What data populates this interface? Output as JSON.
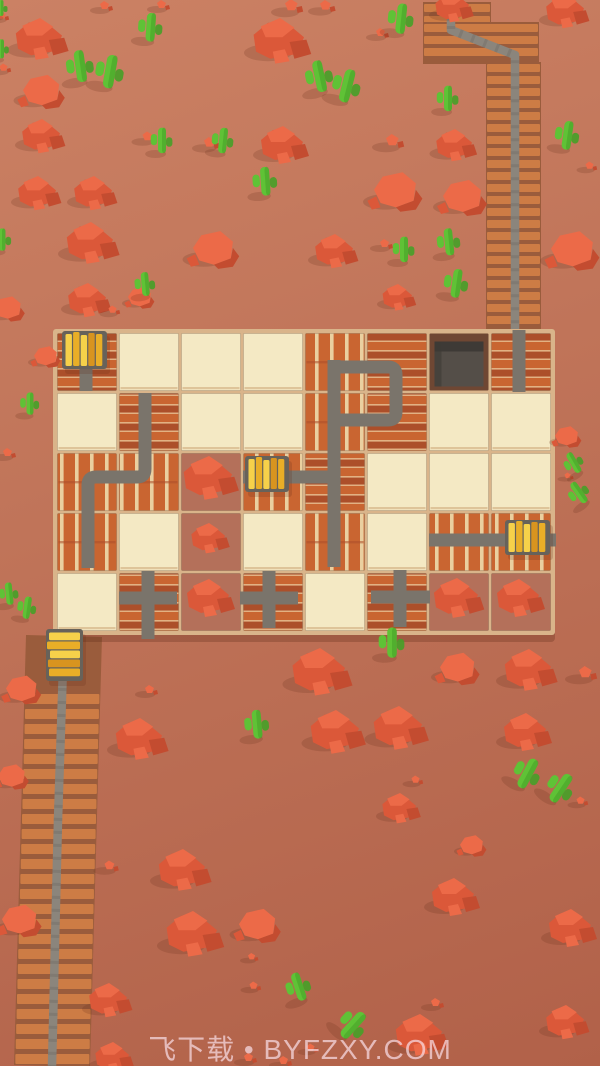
{
  "scene": {
    "width": 600,
    "height": 1066,
    "colors": {
      "track": "#7a746b",
      "rail": "#8b857c",
      "railDash": "#5f5a53",
      "tie": "#cd7c45",
      "tieBase": "#9a5c3c",
      "cream": "#f4e9c4",
      "creamEdge": "#d9bd92",
      "brick": "#c96531",
      "brickDark": "#ac4f2a",
      "mortar": "#e2b183",
      "stripe": "#ead0a0",
      "dirt": "#b4705a",
      "pitFrame": "#6f4733",
      "pitInner": "#544e48",
      "pitShade": "#3e3a36",
      "boardBase": "#d9b48a",
      "boardShadow": "rgba(90,40,20,0.28)",
      "rockBright": "#ec6a48",
      "rockMid": "#db5839",
      "rockDark": "#c34c30",
      "cactus": "#5fc236",
      "cactusDark": "#46a028",
      "gold1": "#f6d14a",
      "gold2": "#e9ae27",
      "gold3": "#d8941f",
      "cartFrame": "#67625a",
      "shadow": "rgba(100,45,25,0.20)"
    },
    "board": {
      "x": 56,
      "y": 332,
      "cols": 8,
      "rows": 5,
      "cellW": 62,
      "cellH": 60,
      "legend": {
        "BH": "brick-horizontal",
        "BV": "brick-vertical-planks",
        "CR": "cream",
        "DR": "dirt-rocks",
        "PT": "tunnel-pit"
      },
      "tiles": [
        [
          "BH",
          "CR",
          "CR",
          "CR",
          "BV",
          "BH",
          "PT",
          "BH"
        ],
        [
          "CR",
          "BH",
          "CR",
          "CR",
          "BV",
          "BH",
          "CR",
          "CR"
        ],
        [
          "BV",
          "BV",
          "DR",
          "BV",
          "BH",
          "CR",
          "CR",
          "CR"
        ],
        [
          "BV",
          "CR",
          "DR",
          "CR",
          "BV",
          "CR",
          "BV",
          "BV"
        ],
        [
          "CR",
          "BH",
          "DR",
          "BH",
          "CR",
          "BH",
          "DR",
          "DR"
        ]
      ],
      "dirtPiles": [
        [
          2,
          2,
          1.15
        ],
        [
          2,
          3,
          0.8
        ],
        [
          2,
          4,
          1.0
        ],
        [
          6,
          4,
          1.05
        ],
        [
          7,
          4,
          1.0
        ]
      ]
    },
    "tracks": [
      {
        "name": "cart1-stub",
        "d": "M86,340 L86,391"
      },
      {
        "name": "left-zigzag",
        "d": "M145,393 L145,469 Q145,477 137,477 L96,477 Q88,477 88,485 L88,568"
      },
      {
        "name": "center-vertical",
        "d": "M334,360 L334,567"
      },
      {
        "name": "loop",
        "d": "M334,367 L388,367 Q396,367 396,375 L396,412 Q396,420 388,420 L334,420"
      },
      {
        "name": "cart2-horizontal",
        "d": "M243,477 L334,477"
      },
      {
        "name": "entry-vertical",
        "d": "M519,330 L519,392"
      },
      {
        "name": "cart3-horizontal",
        "d": "M429,540 L556,540"
      },
      {
        "name": "cross1-h",
        "d": "M119,598 L177,598"
      },
      {
        "name": "cross1-v",
        "d": "M148,571 L148,639"
      },
      {
        "name": "cross2-h",
        "d": "M240,598 L298,598"
      },
      {
        "name": "cross2-v",
        "d": "M269,571 L269,628"
      },
      {
        "name": "cross3-h",
        "d": "M371,597 L430,597"
      },
      {
        "name": "cross3-v",
        "d": "M400,570 L400,627"
      }
    ],
    "rails": [
      {
        "name": "rail-top",
        "d": "M451,0 L451,30 L515,55 L515,333"
      },
      {
        "name": "rail-bottom",
        "d": "M64,636 L58,820 L52,1066"
      }
    ],
    "topTieRegions": [
      {
        "x": 423,
        "y": 2,
        "w": 68,
        "h": 34
      },
      {
        "x": 423,
        "y": 22,
        "w": 116,
        "h": 42
      },
      {
        "x": 486,
        "y": 62,
        "w": 55,
        "h": 272
      }
    ],
    "bottomCauseway": {
      "yStart": 694,
      "yEnd": 1060,
      "step": 15,
      "tieW": 74,
      "tieH": 10,
      "railX1": 64,
      "railY1": 636,
      "railX2": 52,
      "railY2": 1066
    },
    "carts": [
      {
        "name": "gold-cart-1",
        "x": 62,
        "y": 331,
        "w": 45,
        "h": 38,
        "o": "h"
      },
      {
        "name": "gold-cart-2",
        "x": 245,
        "y": 456,
        "w": 44,
        "h": 36,
        "o": "h"
      },
      {
        "name": "gold-cart-3",
        "x": 505,
        "y": 520,
        "w": 45,
        "h": 35,
        "o": "h"
      },
      {
        "name": "gold-cart-4",
        "x": 46,
        "y": 629,
        "w": 37,
        "h": 52,
        "o": "v"
      }
    ],
    "rocks": [
      [
        40,
        40,
        1.1,
        0
      ],
      [
        280,
        42,
        1.2,
        0
      ],
      [
        105,
        6,
        0.5,
        2
      ],
      [
        162,
        5,
        0.5,
        2
      ],
      [
        292,
        6,
        0.7,
        2
      ],
      [
        326,
        6,
        0.6,
        2
      ],
      [
        42,
        92,
        0.95,
        1
      ],
      [
        2,
        16,
        0.45,
        2
      ],
      [
        4,
        68,
        0.45,
        2
      ],
      [
        42,
        137,
        0.9,
        0
      ],
      [
        148,
        137,
        0.55,
        2
      ],
      [
        210,
        143,
        0.6,
        2
      ],
      [
        283,
        146,
        1.0,
        0
      ],
      [
        393,
        141,
        0.7,
        2
      ],
      [
        396,
        192,
        1.1,
        1
      ],
      [
        38,
        194,
        0.9,
        0
      ],
      [
        94,
        194,
        0.9,
        0
      ],
      [
        91,
        244,
        1.1,
        0
      ],
      [
        214,
        250,
        1.05,
        1
      ],
      [
        335,
        252,
        0.9,
        0
      ],
      [
        385,
        244,
        0.5,
        2
      ],
      [
        398,
        298,
        0.7,
        0
      ],
      [
        88,
        301,
        0.9,
        0
      ],
      [
        140,
        298,
        0.6,
        1
      ],
      [
        8,
        309,
        0.7,
        1
      ],
      [
        113,
        310,
        0.45,
        2
      ],
      [
        453,
        8,
        0.8,
        0
      ],
      [
        566,
        12,
        0.9,
        0
      ],
      [
        381,
        33,
        0.5,
        2
      ],
      [
        455,
        146,
        0.85,
        0
      ],
      [
        463,
        198,
        1.0,
        1
      ],
      [
        573,
        251,
        1.1,
        1
      ],
      [
        590,
        166,
        0.45,
        2
      ],
      [
        46,
        357,
        0.6,
        1
      ],
      [
        8,
        453,
        0.5,
        2
      ],
      [
        567,
        437,
        0.6,
        1
      ],
      [
        568,
        476,
        0.35,
        2
      ],
      [
        22,
        690,
        0.8,
        1
      ],
      [
        12,
        777,
        0.7,
        1
      ],
      [
        320,
        673,
        1.25,
        0
      ],
      [
        140,
        740,
        1.1,
        0
      ],
      [
        150,
        690,
        0.5,
        2
      ],
      [
        458,
        669,
        0.9,
        1
      ],
      [
        529,
        671,
        1.1,
        0
      ],
      [
        586,
        673,
        0.7,
        2
      ],
      [
        336,
        733,
        1.15,
        0
      ],
      [
        399,
        729,
        1.15,
        0
      ],
      [
        526,
        733,
        1.0,
        0
      ],
      [
        400,
        809,
        0.8,
        0
      ],
      [
        416,
        780,
        0.45,
        2
      ],
      [
        581,
        801,
        0.45,
        2
      ],
      [
        472,
        846,
        0.6,
        1
      ],
      [
        110,
        866,
        0.55,
        2
      ],
      [
        183,
        871,
        1.1,
        0
      ],
      [
        193,
        935,
        1.2,
        0
      ],
      [
        258,
        926,
        0.95,
        1
      ],
      [
        454,
        898,
        1.0,
        0
      ],
      [
        571,
        929,
        1.0,
        0
      ],
      [
        20,
        921,
        0.9,
        1
      ],
      [
        109,
        1001,
        0.9,
        0
      ],
      [
        254,
        986,
        0.45,
        2
      ],
      [
        252,
        957,
        0.4,
        2
      ],
      [
        113,
        1058,
        0.8,
        0
      ],
      [
        249,
        1058,
        0.5,
        2
      ],
      [
        284,
        1061,
        0.5,
        2
      ],
      [
        420,
        1036,
        1.1,
        0
      ],
      [
        436,
        1003,
        0.5,
        2
      ],
      [
        566,
        1023,
        0.9,
        0
      ],
      [
        311,
        1048,
        0.45,
        2
      ]
    ],
    "cacti": [
      [
        82,
        78,
        1.0,
        -8
      ],
      [
        108,
        84,
        1.05,
        10
      ],
      [
        150,
        38,
        0.9,
        4
      ],
      [
        400,
        30,
        0.95,
        6
      ],
      [
        322,
        88,
        1.0,
        -12
      ],
      [
        344,
        98,
        1.05,
        14
      ],
      [
        162,
        150,
        0.8,
        0
      ],
      [
        222,
        150,
        0.8,
        6
      ],
      [
        266,
        192,
        0.9,
        -4
      ],
      [
        448,
        108,
        0.8,
        0
      ],
      [
        566,
        146,
        0.9,
        8
      ],
      [
        404,
        259,
        0.8,
        0
      ],
      [
        450,
        252,
        0.85,
        -6
      ],
      [
        455,
        294,
        0.9,
        8
      ],
      [
        146,
        293,
        0.75,
        -5
      ],
      [
        1,
        14,
        0.5,
        0
      ],
      [
        1,
        56,
        0.6,
        0
      ],
      [
        2,
        248,
        0.7,
        0
      ],
      [
        30,
        412,
        0.7,
        0
      ],
      [
        10,
        602,
        0.7,
        -6
      ],
      [
        26,
        616,
        0.7,
        8
      ],
      [
        578,
        470,
        0.7,
        -30
      ],
      [
        584,
        500,
        0.75,
        -35
      ],
      [
        392,
        654,
        0.95,
        0
      ],
      [
        258,
        735,
        0.9,
        -5
      ],
      [
        522,
        784,
        1.0,
        28
      ],
      [
        554,
        798,
        1.0,
        34
      ],
      [
        302,
        997,
        0.9,
        -18
      ],
      [
        345,
        1034,
        1.0,
        42
      ]
    ]
  },
  "watermark": {
    "text": "飞下载 • BYFZXY.COM"
  }
}
